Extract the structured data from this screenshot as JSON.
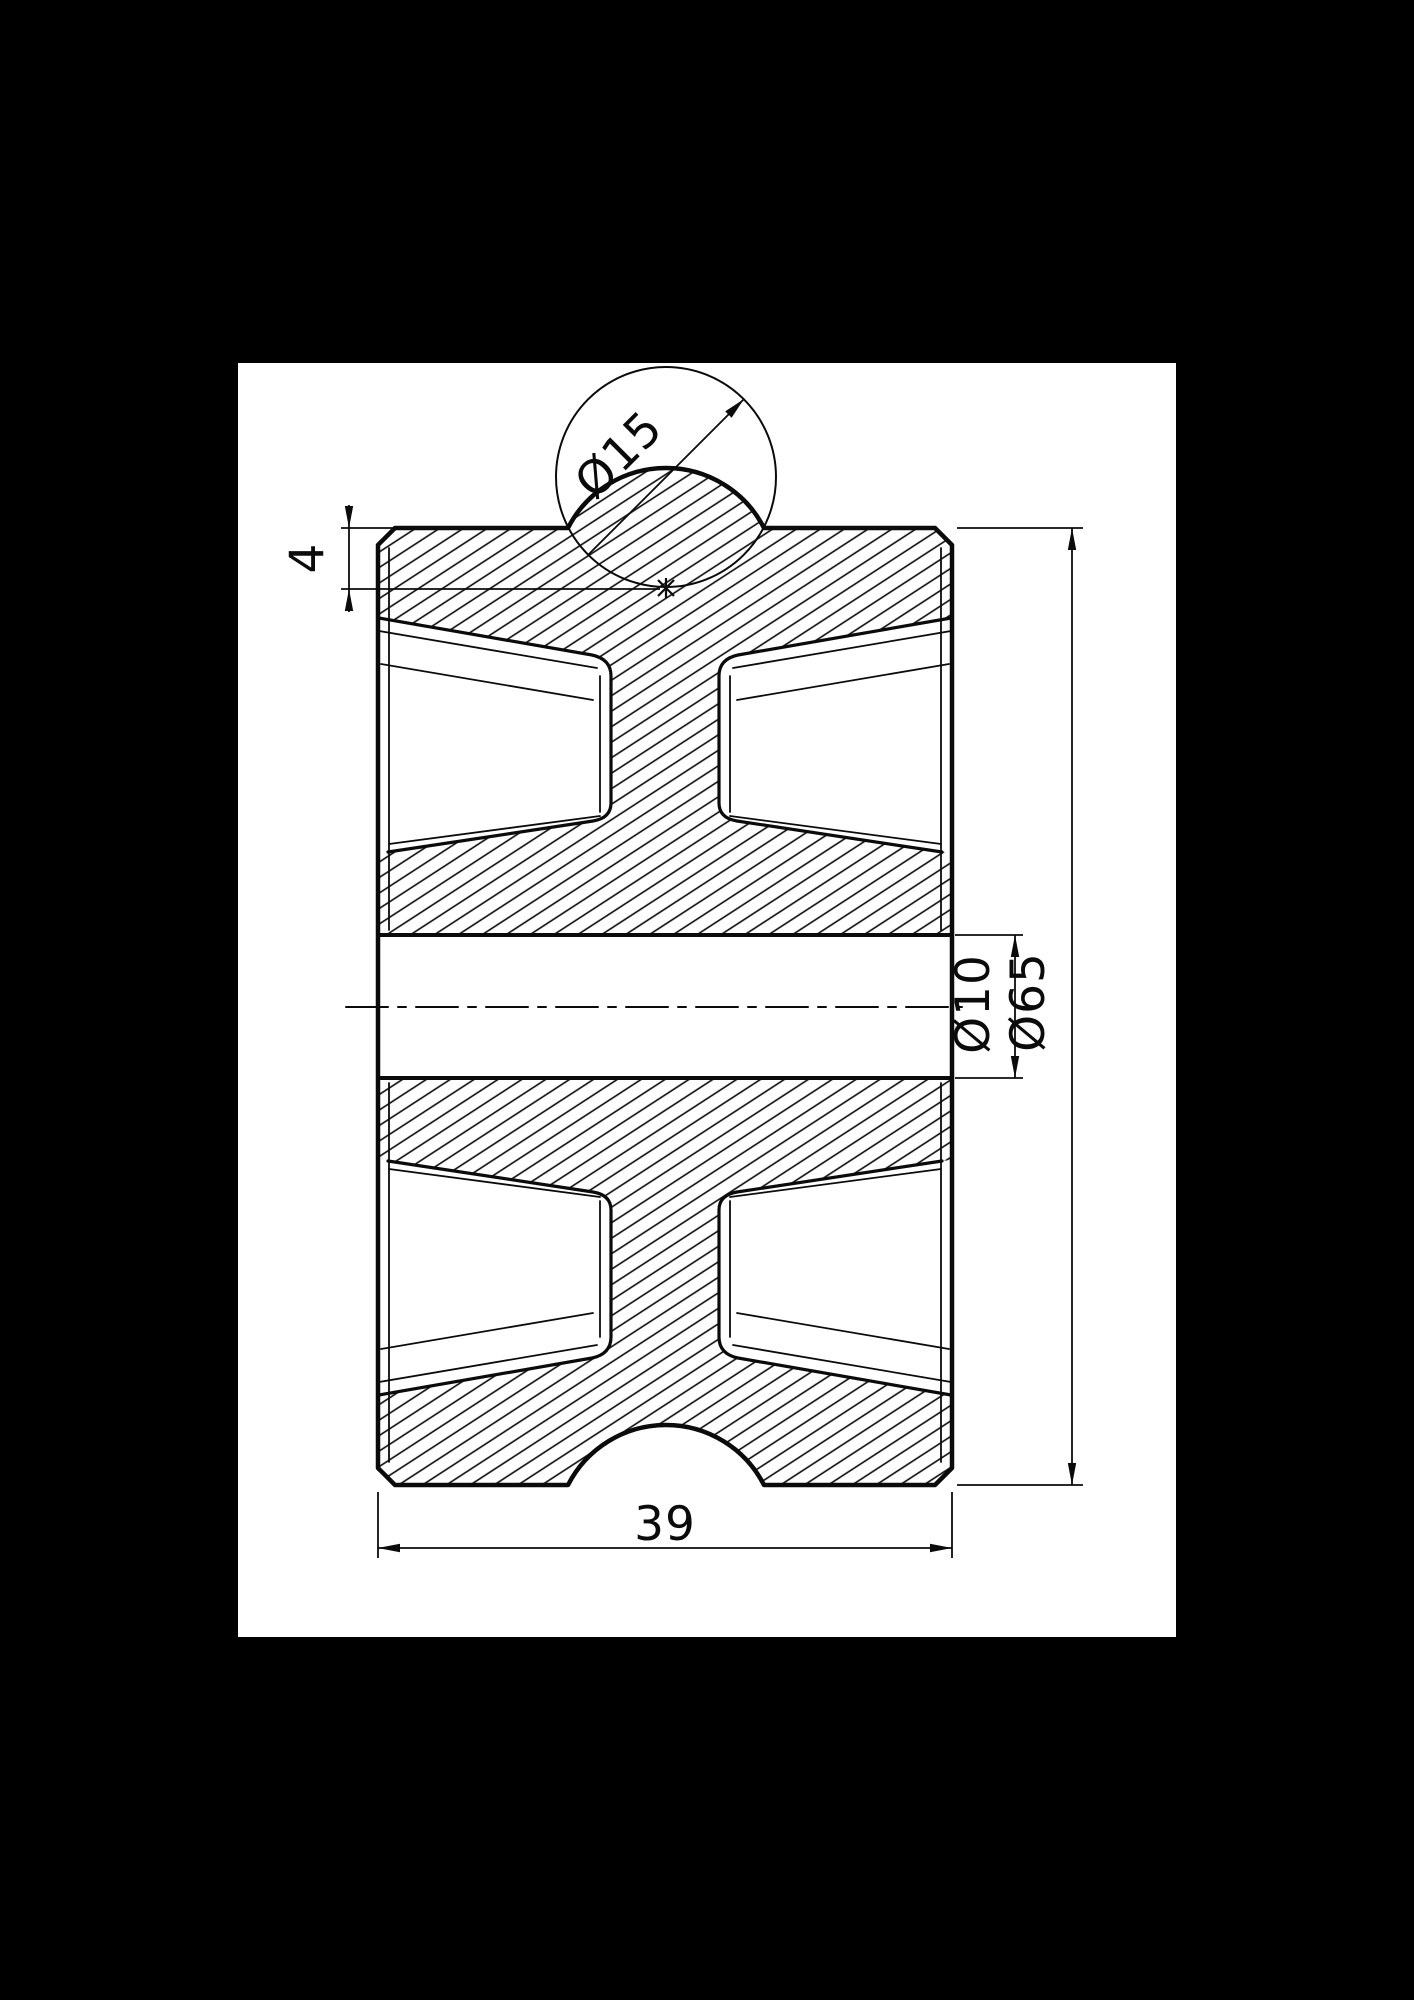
{
  "colors": {
    "background": "#000000",
    "sheet": "#ffffff",
    "line": "#0b0b0b"
  },
  "drawing": {
    "kind": "mechanical-part-section-view",
    "dimensions": {
      "groove_diameter": {
        "label": "Ø15",
        "value": 15
      },
      "groove_depth": {
        "label": "4",
        "value": 4
      },
      "bore_diameter": {
        "label": "Ø10",
        "value": 10
      },
      "outer_diameter": {
        "label": "Ø65",
        "value": 65
      },
      "overall_width": {
        "label": "39",
        "value": 39
      }
    }
  }
}
